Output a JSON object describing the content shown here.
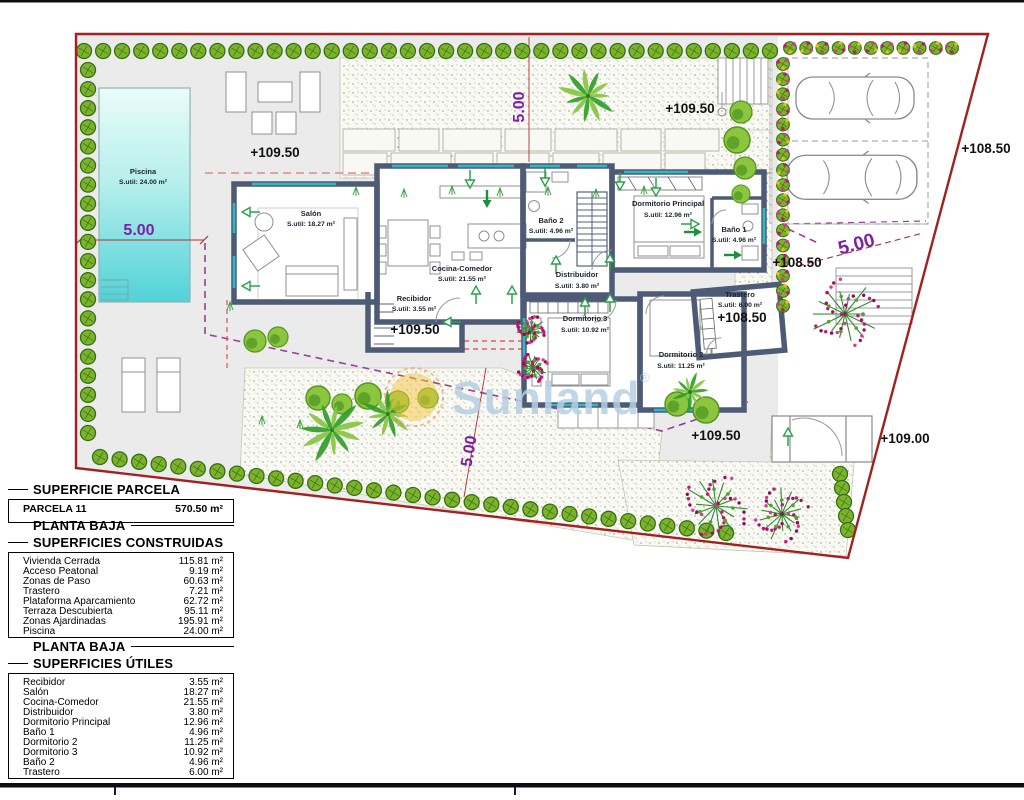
{
  "plan": {
    "watermark": {
      "text": "Sunland",
      "reg": "®"
    },
    "pool": {
      "name": "Piscina",
      "area": "S.util: 24.00 m²"
    },
    "rooms": {
      "salon": {
        "name": "Salón",
        "area": "S.util: 18.27 m²"
      },
      "cocina": {
        "name": "Cocina-Comedor",
        "area": "S.util: 21.55 m²"
      },
      "recibidor": {
        "name": "Recibidor",
        "area": "S.util: 3.55 m²"
      },
      "bano2": {
        "name": "Baño 2",
        "area": "S.util: 4.96 m²"
      },
      "distribuidor": {
        "name": "Distribuidor",
        "area": "S.util: 3.80 m²"
      },
      "dormppal": {
        "name": "Dormitorio Principal",
        "area": "S.util: 12.96 m²"
      },
      "bano1": {
        "name": "Baño 1",
        "area": "S.util: 4.96 m²"
      },
      "dorm3": {
        "name": "Dormitorio 3",
        "area": "S.util: 10.92 m²"
      },
      "dorm2": {
        "name": "Dormitorio 2",
        "area": "S.util: 11.25 m²"
      },
      "trastero": {
        "name": "Trastero",
        "area": "S.util: 6.00 m²"
      }
    },
    "elevations": {
      "pool_terrace": "+109.50",
      "top_path": "+109.50",
      "right_upper": "+108.50",
      "trastero": "+108.50",
      "entrance": "+109.50",
      "bottom_path": "+109.50",
      "bottom_right": "+109.00",
      "outside_right": "+108.50"
    },
    "dimensions": {
      "pool": "5.00",
      "top": "5.00",
      "bottom": "5.00",
      "right": "5.00"
    }
  },
  "tables": {
    "parcel": {
      "title": "SUPERFICIE PARCELA",
      "rows": [
        {
          "label": "PARCELA 11",
          "value": "570.50 m²"
        }
      ]
    },
    "built": {
      "title_line1": "PLANTA BAJA",
      "title_line2": "SUPERFICIES CONSTRUIDAS",
      "rows": [
        {
          "label": "Vivienda Cerrada",
          "value": "115.81 m²"
        },
        {
          "label": "Acceso Peatonal",
          "value": "9.19 m²"
        },
        {
          "label": "Zonas de Paso",
          "value": "60.63 m²"
        },
        {
          "label": "Trastero",
          "value": "7.21 m²"
        },
        {
          "label": "Plataforma Aparcamiento",
          "value": "62.72 m²"
        },
        {
          "label": "Terraza Descubierta",
          "value": "95.11 m²"
        },
        {
          "label": "Zonas Ajardinadas",
          "value": "195.91 m²"
        },
        {
          "label": "Piscina",
          "value": "24.00 m²"
        }
      ]
    },
    "useful": {
      "title_line1": "PLANTA BAJA",
      "title_line2": "SUPERFICIES ÚTILES",
      "rows": [
        {
          "label": "Recibidor",
          "value": "3.55 m²"
        },
        {
          "label": "Salón",
          "value": "18.27 m²"
        },
        {
          "label": "Cocina-Comedor",
          "value": "21.55 m²"
        },
        {
          "label": "Distribuidor",
          "value": "3.80 m²"
        },
        {
          "label": "Dormitorio Principal",
          "value": "12.96 m²"
        },
        {
          "label": "Baño 1",
          "value": "4.96 m²"
        },
        {
          "label": "Dormitorio 2",
          "value": "11.25 m²"
        },
        {
          "label": "Dormitorio 3",
          "value": "10.92 m²"
        },
        {
          "label": "Baño 2",
          "value": "4.96 m²"
        },
        {
          "label": "Trastero",
          "value": "6.00 m²"
        }
      ]
    }
  },
  "colors": {
    "boundary_red": "#a32020",
    "wall_dark": "#4e5b76",
    "window_cyan": "#2fb6c9",
    "bush_green": "#7db32c",
    "arrow_green": "#1d8f3c",
    "dimension_purple": "#7d1fa8",
    "flower_magenta": "#c1157b",
    "pool_cyan": "#52d2d8",
    "terrace_gray": "#ebebeb",
    "watermark_blue": "#b7cfe2",
    "sun_yellow": "#f5c33c"
  }
}
